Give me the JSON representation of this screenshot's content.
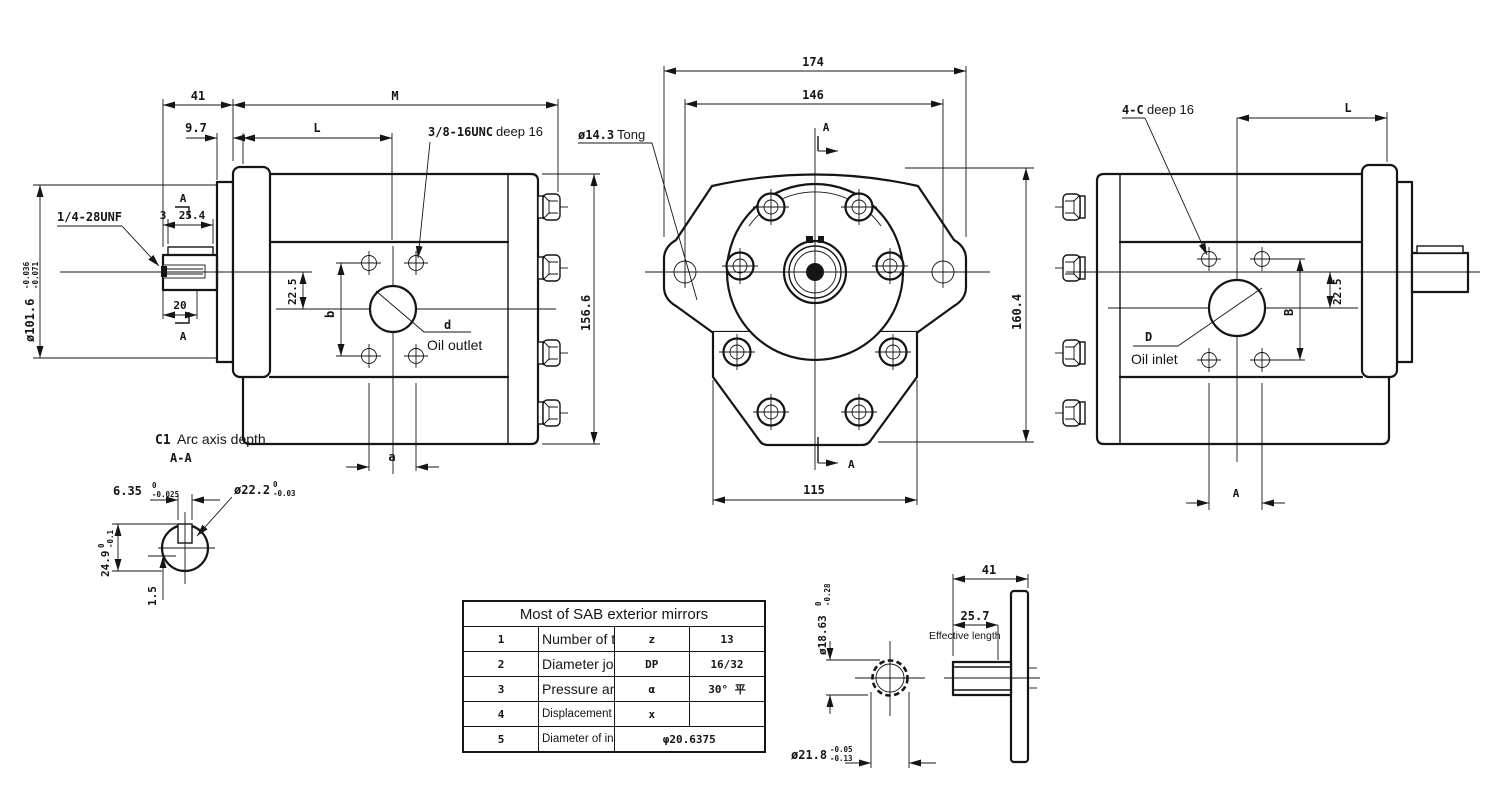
{
  "left_view": {
    "dim_41": "41",
    "dim_M": "M",
    "dim_97": "9.7",
    "dim_L": "L",
    "unc_label": "3/8-16UNC",
    "unc_suffix": "deep 16",
    "unf_label": "1/4-28UNF",
    "pilot_dia": {
      "main": "ø101.6",
      "sup": "-0.036",
      "sub": "-0.071"
    },
    "dim_3": "3",
    "dim_254": "25.4",
    "dim_20": "20",
    "dim_225": "22.5",
    "dim_b": "b",
    "dim_a": "a",
    "dim_1566": "156.6",
    "port_ref": "d",
    "port_label": "Oil outlet",
    "section_top": "A",
    "section_bottom": "A"
  },
  "front_view": {
    "dim_174": "174",
    "dim_146": "146",
    "dim_115": "115",
    "dim_1604": "160.4",
    "hole_dia": "ø14.3",
    "hole_suffix": "Tong",
    "section_top": "A",
    "section_bottom": "A"
  },
  "right_view": {
    "bolt_label": "4-C",
    "bolt_suffix": "deep 16",
    "dim_L": "L",
    "dim_B": "B",
    "dim_225": "22.5",
    "dim_A": "A",
    "port_ref": "D",
    "port_label": "Oil inlet"
  },
  "section_detail": {
    "title_c1": "C1",
    "title": "Arc axis depth",
    "subtitle": "A-A",
    "key_width": {
      "main": "6.35",
      "sup": "0",
      "sub": "-0.025"
    },
    "shaft_dia": {
      "main": "ø22.2",
      "sup": "0",
      "sub": "-0.03"
    },
    "overall": {
      "main": "24.9",
      "sup": "0",
      "sub": "-0.1"
    },
    "key_height": "1.5"
  },
  "spline_detail": {
    "minor_dia": {
      "main": "ø18.63",
      "sup": "0",
      "sub": "-0.28"
    },
    "major_dia": {
      "main": "ø21.8",
      "sup": "-0.05",
      "sub": "-0.13"
    },
    "dim_41": "41",
    "dim_257": "25.7",
    "eff_label": "Effective length"
  },
  "spec_table": {
    "title": "Most of SAB exterior mirrors",
    "rows": [
      {
        "no": "1",
        "name": "Number of teeth",
        "symbol": "z",
        "value": "13"
      },
      {
        "no": "2",
        "name": "Diameter joint",
        "symbol": "DP",
        "value": "16/32"
      },
      {
        "no": "3",
        "name": "Pressure angle",
        "symbol": "α",
        "value": "30° 平"
      },
      {
        "no": "4",
        "name": "Displacement coefficient",
        "symbol": "x",
        "value": ""
      },
      {
        "no": "5",
        "name": "Diameter of indexing circle",
        "symbol": "",
        "value": "φ20.6375"
      }
    ]
  }
}
